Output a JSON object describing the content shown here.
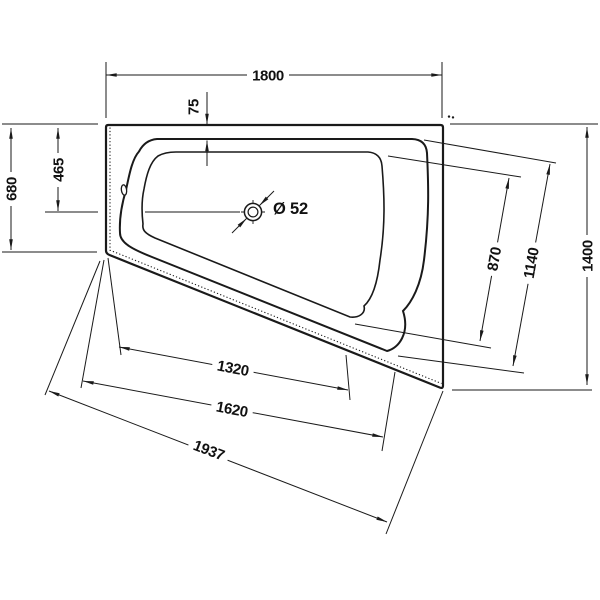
{
  "drawing": {
    "type": "technical-drawing",
    "subject": "corner bathtub top view with waste outlet",
    "units": "mm",
    "line_color": "#1a1a1a",
    "background": "#ffffff",
    "labels": {
      "width_top": "1800",
      "rim_width_top": "75",
      "left_side_depth": "680",
      "drain_center_from_top": "465",
      "drain_diameter": "Ø 52",
      "right_basin_length": "870",
      "right_rim_length": "1140",
      "right_side_depth": "1400",
      "basin_bottom_length": "1320",
      "rim_bottom_length": "1620",
      "front_edge_length": "1937"
    }
  }
}
